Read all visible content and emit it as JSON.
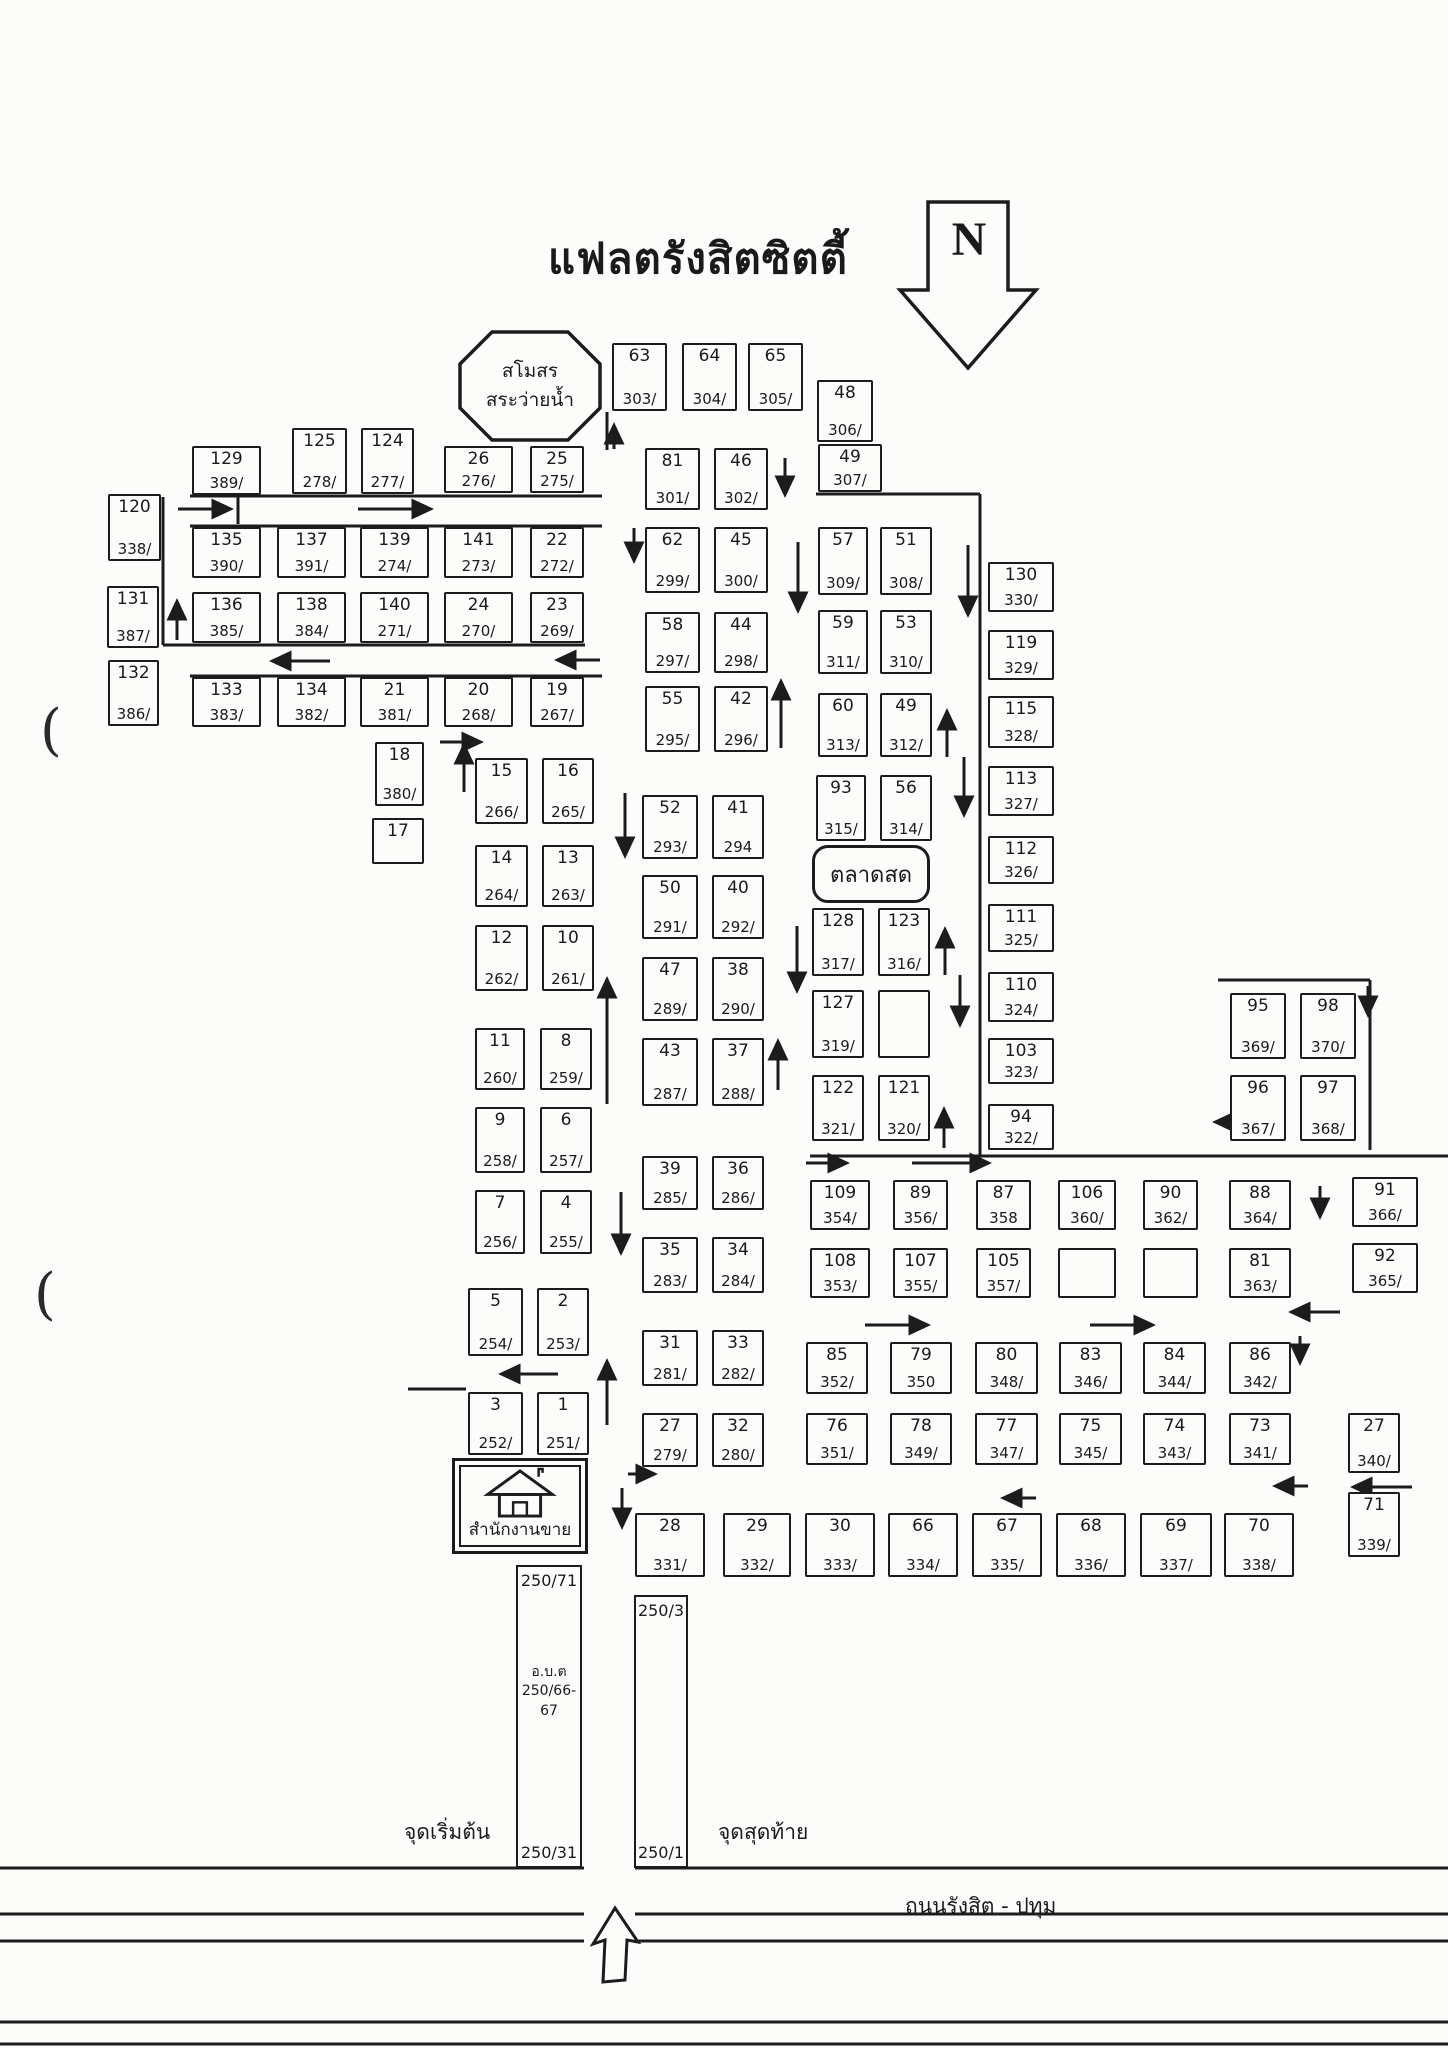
{
  "title": "แฟลตรังสิตซิตตี้",
  "north_label": "N",
  "colors": {
    "ink": "#1c1c1c",
    "paper": "#fcfcfa"
  },
  "landmarks": {
    "club": {
      "line1": "สโมสร",
      "line2": "สระว่ายน้ำ"
    },
    "market": {
      "label": "ตลาดสด"
    },
    "office": {
      "label": "สำนักงานขาย"
    },
    "strip_left": {
      "top": "250/71",
      "mid1": "อ.บ.ต",
      "mid2": "250/66-67",
      "bottom": "250/31"
    },
    "strip_right": {
      "top": "250/3",
      "bottom": "250/1"
    }
  },
  "road": {
    "name": "ถนนรังสิต - ปทุม",
    "start_label": "จุดเริ่มต้น",
    "end_label": "จุดสุดท้าย"
  },
  "blocks": [
    {
      "u": "129",
      "a": "389/",
      "x": 192,
      "y": 446,
      "w": 69,
      "h": 49
    },
    {
      "u": "125",
      "a": "278/",
      "x": 292,
      "y": 428,
      "w": 55,
      "h": 66
    },
    {
      "u": "124",
      "a": "277/",
      "x": 361,
      "y": 428,
      "w": 53,
      "h": 66
    },
    {
      "u": "26",
      "a": "276/",
      "x": 444,
      "y": 446,
      "w": 69,
      "h": 47
    },
    {
      "u": "25",
      "a": "275/",
      "x": 530,
      "y": 446,
      "w": 54,
      "h": 47
    },
    {
      "u": "120",
      "a": "338/",
      "x": 108,
      "y": 494,
      "w": 53,
      "h": 67
    },
    {
      "u": "135",
      "a": "390/",
      "x": 192,
      "y": 527,
      "w": 69,
      "h": 51
    },
    {
      "u": "137",
      "a": "391/",
      "x": 277,
      "y": 527,
      "w": 69,
      "h": 51
    },
    {
      "u": "139",
      "a": "274/",
      "x": 360,
      "y": 527,
      "w": 69,
      "h": 51
    },
    {
      "u": "141",
      "a": "273/",
      "x": 444,
      "y": 527,
      "w": 69,
      "h": 51
    },
    {
      "u": "22",
      "a": "272/",
      "x": 530,
      "y": 527,
      "w": 54,
      "h": 51
    },
    {
      "u": "131",
      "a": "387/",
      "x": 107,
      "y": 586,
      "w": 52,
      "h": 62
    },
    {
      "u": "136",
      "a": "385/",
      "x": 192,
      "y": 592,
      "w": 69,
      "h": 51
    },
    {
      "u": "138",
      "a": "384/",
      "x": 277,
      "y": 592,
      "w": 69,
      "h": 51
    },
    {
      "u": "140",
      "a": "271/",
      "x": 360,
      "y": 592,
      "w": 69,
      "h": 51
    },
    {
      "u": "24",
      "a": "270/",
      "x": 444,
      "y": 592,
      "w": 69,
      "h": 51
    },
    {
      "u": "23",
      "a": "269/",
      "x": 530,
      "y": 592,
      "w": 54,
      "h": 51
    },
    {
      "u": "132",
      "a": "386/",
      "x": 108,
      "y": 660,
      "w": 51,
      "h": 66
    },
    {
      "u": "133",
      "a": "383/",
      "x": 192,
      "y": 677,
      "w": 69,
      "h": 50
    },
    {
      "u": "134",
      "a": "382/",
      "x": 277,
      "y": 677,
      "w": 69,
      "h": 50
    },
    {
      "u": "21",
      "a": "381/",
      "x": 360,
      "y": 677,
      "w": 69,
      "h": 50
    },
    {
      "u": "20",
      "a": "268/",
      "x": 444,
      "y": 677,
      "w": 69,
      "h": 50
    },
    {
      "u": "19",
      "a": "267/",
      "x": 530,
      "y": 677,
      "w": 54,
      "h": 50
    },
    {
      "u": "18",
      "a": "380/",
      "x": 375,
      "y": 742,
      "w": 49,
      "h": 64
    },
    {
      "u": "17",
      "a": "",
      "x": 372,
      "y": 818,
      "w": 52,
      "h": 46
    },
    {
      "u": "63",
      "a": "303/",
      "x": 612,
      "y": 343,
      "w": 55,
      "h": 68
    },
    {
      "u": "64",
      "a": "304/",
      "x": 682,
      "y": 343,
      "w": 55,
      "h": 68
    },
    {
      "u": "65",
      "a": "305/",
      "x": 748,
      "y": 343,
      "w": 55,
      "h": 68
    },
    {
      "u": "48",
      "a": "306/",
      "x": 817,
      "y": 380,
      "w": 56,
      "h": 62
    },
    {
      "u": "81",
      "a": "301/",
      "x": 645,
      "y": 448,
      "w": 55,
      "h": 62
    },
    {
      "u": "46",
      "a": "302/",
      "x": 714,
      "y": 448,
      "w": 54,
      "h": 62
    },
    {
      "u": "62",
      "a": "299/",
      "x": 645,
      "y": 527,
      "w": 55,
      "h": 66
    },
    {
      "u": "45",
      "a": "300/",
      "x": 714,
      "y": 527,
      "w": 54,
      "h": 66
    },
    {
      "u": "58",
      "a": "297/",
      "x": 645,
      "y": 612,
      "w": 55,
      "h": 61
    },
    {
      "u": "44",
      "a": "298/",
      "x": 714,
      "y": 612,
      "w": 54,
      "h": 61
    },
    {
      "u": "55",
      "a": "295/",
      "x": 645,
      "y": 686,
      "w": 55,
      "h": 66
    },
    {
      "u": "42",
      "a": "296/",
      "x": 714,
      "y": 686,
      "w": 54,
      "h": 66
    },
    {
      "u": "49",
      "a": "307/",
      "x": 818,
      "y": 444,
      "w": 64,
      "h": 48
    },
    {
      "u": "57",
      "a": "309/",
      "x": 818,
      "y": 527,
      "w": 50,
      "h": 68
    },
    {
      "u": "51",
      "a": "308/",
      "x": 880,
      "y": 527,
      "w": 52,
      "h": 68
    },
    {
      "u": "59",
      "a": "311/",
      "x": 818,
      "y": 610,
      "w": 50,
      "h": 64
    },
    {
      "u": "53",
      "a": "310/",
      "x": 880,
      "y": 610,
      "w": 52,
      "h": 64
    },
    {
      "u": "60",
      "a": "313/",
      "x": 818,
      "y": 693,
      "w": 50,
      "h": 64
    },
    {
      "u": "49",
      "a": "312/",
      "x": 880,
      "y": 693,
      "w": 52,
      "h": 64
    },
    {
      "u": "93",
      "a": "315/",
      "x": 816,
      "y": 775,
      "w": 50,
      "h": 66
    },
    {
      "u": "56",
      "a": "314/",
      "x": 880,
      "y": 775,
      "w": 52,
      "h": 66
    },
    {
      "u": "15",
      "a": "266/",
      "x": 475,
      "y": 758,
      "w": 53,
      "h": 66
    },
    {
      "u": "16",
      "a": "265/",
      "x": 542,
      "y": 758,
      "w": 52,
      "h": 66
    },
    {
      "u": "14",
      "a": "264/",
      "x": 475,
      "y": 845,
      "w": 53,
      "h": 62
    },
    {
      "u": "13",
      "a": "263/",
      "x": 542,
      "y": 845,
      "w": 52,
      "h": 62
    },
    {
      "u": "12",
      "a": "262/",
      "x": 475,
      "y": 925,
      "w": 53,
      "h": 66
    },
    {
      "u": "10",
      "a": "261/",
      "x": 542,
      "y": 925,
      "w": 52,
      "h": 66
    },
    {
      "u": "11",
      "a": "260/",
      "x": 475,
      "y": 1028,
      "w": 50,
      "h": 62
    },
    {
      "u": "8",
      "a": "259/",
      "x": 540,
      "y": 1028,
      "w": 52,
      "h": 62
    },
    {
      "u": "9",
      "a": "258/",
      "x": 475,
      "y": 1107,
      "w": 50,
      "h": 66
    },
    {
      "u": "6",
      "a": "257/",
      "x": 540,
      "y": 1107,
      "w": 52,
      "h": 66
    },
    {
      "u": "7",
      "a": "256/",
      "x": 475,
      "y": 1190,
      "w": 50,
      "h": 64
    },
    {
      "u": "4",
      "a": "255/",
      "x": 540,
      "y": 1190,
      "w": 52,
      "h": 64
    },
    {
      "u": "5",
      "a": "254/",
      "x": 468,
      "y": 1288,
      "w": 55,
      "h": 68
    },
    {
      "u": "2",
      "a": "253/",
      "x": 537,
      "y": 1288,
      "w": 52,
      "h": 68
    },
    {
      "u": "3",
      "a": "252/",
      "x": 468,
      "y": 1392,
      "w": 55,
      "h": 63
    },
    {
      "u": "1",
      "a": "251/",
      "x": 537,
      "y": 1392,
      "w": 52,
      "h": 63
    },
    {
      "u": "52",
      "a": "293/",
      "x": 642,
      "y": 795,
      "w": 56,
      "h": 64
    },
    {
      "u": "41",
      "a": "294",
      "x": 712,
      "y": 795,
      "w": 52,
      "h": 64
    },
    {
      "u": "50",
      "a": "291/",
      "x": 642,
      "y": 875,
      "w": 56,
      "h": 64
    },
    {
      "u": "40",
      "a": "292/",
      "x": 712,
      "y": 875,
      "w": 52,
      "h": 64
    },
    {
      "u": "47",
      "a": "289/",
      "x": 642,
      "y": 957,
      "w": 56,
      "h": 64
    },
    {
      "u": "38",
      "a": "290/",
      "x": 712,
      "y": 957,
      "w": 52,
      "h": 64
    },
    {
      "u": "43",
      "a": "287/",
      "x": 642,
      "y": 1038,
      "w": 56,
      "h": 68
    },
    {
      "u": "37",
      "a": "288/",
      "x": 712,
      "y": 1038,
      "w": 52,
      "h": 68
    },
    {
      "u": "39",
      "a": "285/",
      "x": 642,
      "y": 1156,
      "w": 56,
      "h": 54
    },
    {
      "u": "36",
      "a": "286/",
      "x": 712,
      "y": 1156,
      "w": 52,
      "h": 54
    },
    {
      "u": "35",
      "a": "283/",
      "x": 642,
      "y": 1237,
      "w": 56,
      "h": 56
    },
    {
      "u": "34",
      "a": "284/",
      "x": 712,
      "y": 1237,
      "w": 52,
      "h": 56
    },
    {
      "u": "31",
      "a": "281/",
      "x": 642,
      "y": 1330,
      "w": 56,
      "h": 56
    },
    {
      "u": "33",
      "a": "282/",
      "x": 712,
      "y": 1330,
      "w": 52,
      "h": 56
    },
    {
      "u": "27",
      "a": "279/",
      "x": 642,
      "y": 1413,
      "w": 56,
      "h": 54
    },
    {
      "u": "32",
      "a": "280/",
      "x": 712,
      "y": 1413,
      "w": 52,
      "h": 54
    },
    {
      "u": "128",
      "a": "317/",
      "x": 812,
      "y": 908,
      "w": 52,
      "h": 68
    },
    {
      "u": "123",
      "a": "316/",
      "x": 878,
      "y": 908,
      "w": 52,
      "h": 68
    },
    {
      "u": "127",
      "a": "319/",
      "x": 812,
      "y": 990,
      "w": 52,
      "h": 68
    },
    {
      "u": "",
      "a": "",
      "x": 878,
      "y": 990,
      "w": 52,
      "h": 68
    },
    {
      "u": "122",
      "a": "321/",
      "x": 812,
      "y": 1075,
      "w": 52,
      "h": 66
    },
    {
      "u": "121",
      "a": "320/",
      "x": 878,
      "y": 1075,
      "w": 52,
      "h": 66
    },
    {
      "u": "130",
      "a": "330/",
      "x": 988,
      "y": 562,
      "w": 66,
      "h": 50
    },
    {
      "u": "119",
      "a": "329/",
      "x": 988,
      "y": 630,
      "w": 66,
      "h": 50
    },
    {
      "u": "115",
      "a": "328/",
      "x": 988,
      "y": 696,
      "w": 66,
      "h": 52
    },
    {
      "u": "113",
      "a": "327/",
      "x": 988,
      "y": 766,
      "w": 66,
      "h": 50
    },
    {
      "u": "112",
      "a": "326/",
      "x": 988,
      "y": 836,
      "w": 66,
      "h": 48
    },
    {
      "u": "111",
      "a": "325/",
      "x": 988,
      "y": 904,
      "w": 66,
      "h": 48
    },
    {
      "u": "110",
      "a": "324/",
      "x": 988,
      "y": 972,
      "w": 66,
      "h": 50
    },
    {
      "u": "103",
      "a": "323/",
      "x": 988,
      "y": 1038,
      "w": 66,
      "h": 46
    },
    {
      "u": "94",
      "a": "322/",
      "x": 988,
      "y": 1104,
      "w": 66,
      "h": 46
    },
    {
      "u": "95",
      "a": "369/",
      "x": 1230,
      "y": 993,
      "w": 56,
      "h": 66
    },
    {
      "u": "98",
      "a": "370/",
      "x": 1300,
      "y": 993,
      "w": 56,
      "h": 66
    },
    {
      "u": "96",
      "a": "367/",
      "x": 1230,
      "y": 1075,
      "w": 56,
      "h": 66
    },
    {
      "u": "97",
      "a": "368/",
      "x": 1300,
      "y": 1075,
      "w": 56,
      "h": 66
    },
    {
      "u": "109",
      "a": "354/",
      "x": 810,
      "y": 1180,
      "w": 60,
      "h": 50
    },
    {
      "u": "89",
      "a": "356/",
      "x": 893,
      "y": 1180,
      "w": 55,
      "h": 50
    },
    {
      "u": "87",
      "a": "358",
      "x": 976,
      "y": 1180,
      "w": 55,
      "h": 50
    },
    {
      "u": "106",
      "a": "360/",
      "x": 1058,
      "y": 1180,
      "w": 58,
      "h": 50
    },
    {
      "u": "90",
      "a": "362/",
      "x": 1143,
      "y": 1180,
      "w": 55,
      "h": 50
    },
    {
      "u": "88",
      "a": "364/",
      "x": 1229,
      "y": 1180,
      "w": 62,
      "h": 50
    },
    {
      "u": "108",
      "a": "353/",
      "x": 810,
      "y": 1248,
      "w": 60,
      "h": 50
    },
    {
      "u": "107",
      "a": "355/",
      "x": 893,
      "y": 1248,
      "w": 55,
      "h": 50
    },
    {
      "u": "105",
      "a": "357/",
      "x": 976,
      "y": 1248,
      "w": 55,
      "h": 50
    },
    {
      "u": "",
      "a": "",
      "x": 1058,
      "y": 1248,
      "w": 58,
      "h": 50
    },
    {
      "u": "",
      "a": "",
      "x": 1143,
      "y": 1248,
      "w": 55,
      "h": 50
    },
    {
      "u": "81",
      "a": "363/",
      "x": 1229,
      "y": 1248,
      "w": 62,
      "h": 50
    },
    {
      "u": "91",
      "a": "366/",
      "x": 1352,
      "y": 1177,
      "w": 66,
      "h": 50
    },
    {
      "u": "92",
      "a": "365/",
      "x": 1352,
      "y": 1243,
      "w": 66,
      "h": 50
    },
    {
      "u": "85",
      "a": "352/",
      "x": 806,
      "y": 1342,
      "w": 62,
      "h": 52
    },
    {
      "u": "79",
      "a": "350",
      "x": 890,
      "y": 1342,
      "w": 62,
      "h": 52
    },
    {
      "u": "80",
      "a": "348/",
      "x": 975,
      "y": 1342,
      "w": 63,
      "h": 52
    },
    {
      "u": "83",
      "a": "346/",
      "x": 1059,
      "y": 1342,
      "w": 63,
      "h": 52
    },
    {
      "u": "84",
      "a": "344/",
      "x": 1143,
      "y": 1342,
      "w": 63,
      "h": 52
    },
    {
      "u": "86",
      "a": "342/",
      "x": 1229,
      "y": 1342,
      "w": 62,
      "h": 52
    },
    {
      "u": "76",
      "a": "351/",
      "x": 806,
      "y": 1413,
      "w": 62,
      "h": 52
    },
    {
      "u": "78",
      "a": "349/",
      "x": 890,
      "y": 1413,
      "w": 62,
      "h": 52
    },
    {
      "u": "77",
      "a": "347/",
      "x": 975,
      "y": 1413,
      "w": 63,
      "h": 52
    },
    {
      "u": "75",
      "a": "345/",
      "x": 1059,
      "y": 1413,
      "w": 63,
      "h": 52
    },
    {
      "u": "74",
      "a": "343/",
      "x": 1143,
      "y": 1413,
      "w": 63,
      "h": 52
    },
    {
      "u": "73",
      "a": "341/",
      "x": 1229,
      "y": 1413,
      "w": 62,
      "h": 52
    },
    {
      "u": "27",
      "a": "340/",
      "x": 1348,
      "y": 1413,
      "w": 52,
      "h": 60
    },
    {
      "u": "71",
      "a": "339/",
      "x": 1348,
      "y": 1492,
      "w": 52,
      "h": 65
    },
    {
      "u": "28",
      "a": "331/",
      "x": 635,
      "y": 1513,
      "w": 70,
      "h": 64
    },
    {
      "u": "29",
      "a": "332/",
      "x": 723,
      "y": 1513,
      "w": 68,
      "h": 64
    },
    {
      "u": "30",
      "a": "333/",
      "x": 805,
      "y": 1513,
      "w": 70,
      "h": 64
    },
    {
      "u": "66",
      "a": "334/",
      "x": 888,
      "y": 1513,
      "w": 70,
      "h": 64
    },
    {
      "u": "67",
      "a": "335/",
      "x": 972,
      "y": 1513,
      "w": 70,
      "h": 64
    },
    {
      "u": "68",
      "a": "336/",
      "x": 1056,
      "y": 1513,
      "w": 70,
      "h": 64
    },
    {
      "u": "69",
      "a": "337/",
      "x": 1140,
      "y": 1513,
      "w": 72,
      "h": 64
    },
    {
      "u": "70",
      "a": "338/",
      "x": 1224,
      "y": 1513,
      "w": 70,
      "h": 64
    }
  ],
  "streets": [
    [
      190,
      496,
      602,
      496
    ],
    [
      190,
      526,
      602,
      526
    ],
    [
      163,
      645,
      585,
      645
    ],
    [
      190,
      676,
      602,
      676
    ],
    [
      163,
      497,
      163,
      645
    ],
    [
      238,
      496,
      238,
      524
    ],
    [
      607,
      412,
      607,
      450
    ],
    [
      816,
      494,
      980,
      494
    ],
    [
      980,
      494,
      980,
      1156
    ],
    [
      810,
      1156,
      1448,
      1156
    ],
    [
      1218,
      980,
      1370,
      980
    ],
    [
      1370,
      980,
      1370,
      1150
    ],
    [
      408,
      1389,
      466,
      1389
    ],
    [
      0,
      1868,
      584,
      1868
    ],
    [
      635,
      1868,
      1448,
      1868
    ],
    [
      0,
      1914,
      584,
      1914
    ],
    [
      635,
      1914,
      1448,
      1914
    ],
    [
      0,
      1941,
      584,
      1941
    ],
    [
      635,
      1941,
      1448,
      1941
    ],
    [
      0,
      2022,
      1448,
      2022
    ],
    [
      0,
      2044,
      1448,
      2044
    ]
  ],
  "arrows": [
    [
      178,
      509,
      228,
      509
    ],
    [
      358,
      509,
      428,
      509
    ],
    [
      177,
      640,
      177,
      604
    ],
    [
      330,
      661,
      275,
      661
    ],
    [
      600,
      660,
      560,
      660
    ],
    [
      440,
      742,
      478,
      742
    ],
    [
      614,
      449,
      614,
      428
    ],
    [
      785,
      458,
      785,
      492
    ],
    [
      798,
      542,
      798,
      608
    ],
    [
      781,
      748,
      781,
      684
    ],
    [
      634,
      528,
      634,
      558
    ],
    [
      968,
      545,
      968,
      612
    ],
    [
      947,
      757,
      947,
      714
    ],
    [
      964,
      757,
      964,
      812
    ],
    [
      625,
      793,
      625,
      853
    ],
    [
      464,
      792,
      464,
      748
    ],
    [
      607,
      1104,
      607,
      982
    ],
    [
      797,
      926,
      797,
      988
    ],
    [
      778,
      1090,
      778,
      1044
    ],
    [
      945,
      975,
      945,
      932
    ],
    [
      960,
      975,
      960,
      1022
    ],
    [
      944,
      1148,
      944,
      1112
    ],
    [
      806,
      1163,
      844,
      1163
    ],
    [
      912,
      1163,
      986,
      1163
    ],
    [
      1368,
      986,
      1368,
      1012
    ],
    [
      1242,
      1122,
      1218,
      1122
    ],
    [
      1320,
      1186,
      1320,
      1214
    ],
    [
      1340,
      1312,
      1294,
      1312
    ],
    [
      865,
      1325,
      925,
      1325
    ],
    [
      1090,
      1325,
      1150,
      1325
    ],
    [
      1300,
      1336,
      1300,
      1360
    ],
    [
      1308,
      1486,
      1278,
      1486
    ],
    [
      1036,
      1498,
      1006,
      1498
    ],
    [
      558,
      1374,
      504,
      1374
    ],
    [
      607,
      1425,
      607,
      1364
    ],
    [
      628,
      1474,
      652,
      1474
    ],
    [
      622,
      1488,
      622,
      1524
    ],
    [
      621,
      1192,
      621,
      1250
    ],
    [
      1412,
      1487,
      1356,
      1487
    ]
  ],
  "artifacts": [
    {
      "t": "(",
      "x": 40,
      "y": 698
    },
    {
      "t": "(",
      "x": 34,
      "y": 1262
    }
  ]
}
